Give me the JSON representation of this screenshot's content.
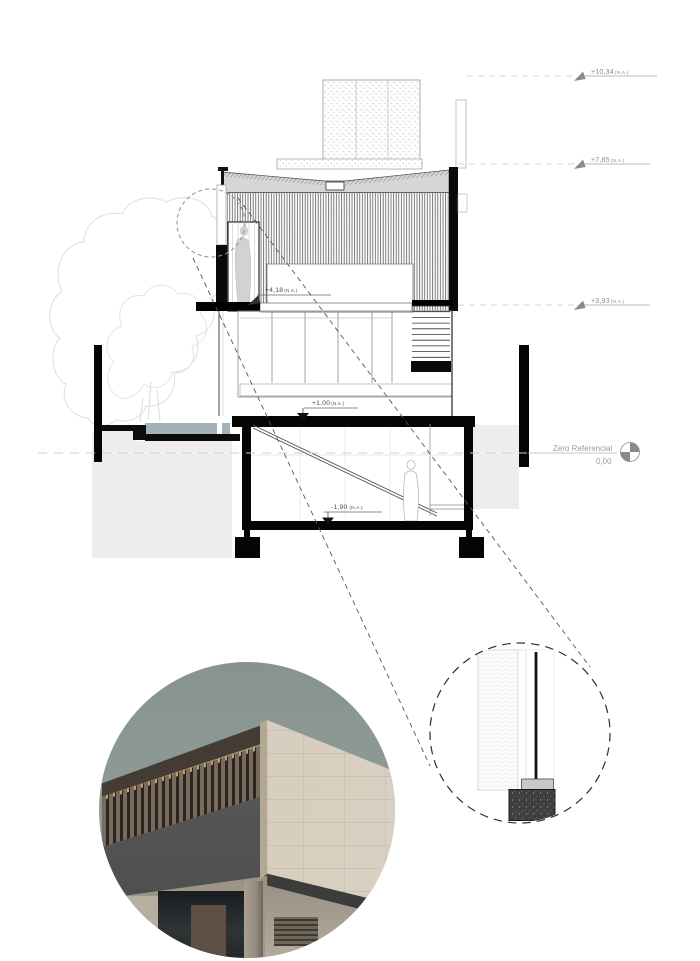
{
  "sheet": {
    "levels": {
      "p1034": {
        "value": "+10,34",
        "na": "(N.A.)"
      },
      "p785": {
        "value": "+7,85",
        "na": "(N.A.)"
      },
      "p393": {
        "value": "+3,93",
        "na": "(N.A.)"
      },
      "p418": {
        "value": "+4,18",
        "na": "(N.A.)"
      },
      "p100": {
        "value": "+1,00",
        "na": "(N.A.)"
      },
      "m190": {
        "value": "-1,90",
        "na": "(N.A.)"
      }
    },
    "datum": {
      "label": "Zero Referencial",
      "value": "0,00"
    },
    "colors": {
      "ink": "#1a1a1a",
      "muted_text": "#9b9b9b",
      "ground_fill": "#ededed",
      "water": "#a3b2b9",
      "concrete_beige": "#d3cabb",
      "sky": "#8c9895"
    }
  }
}
